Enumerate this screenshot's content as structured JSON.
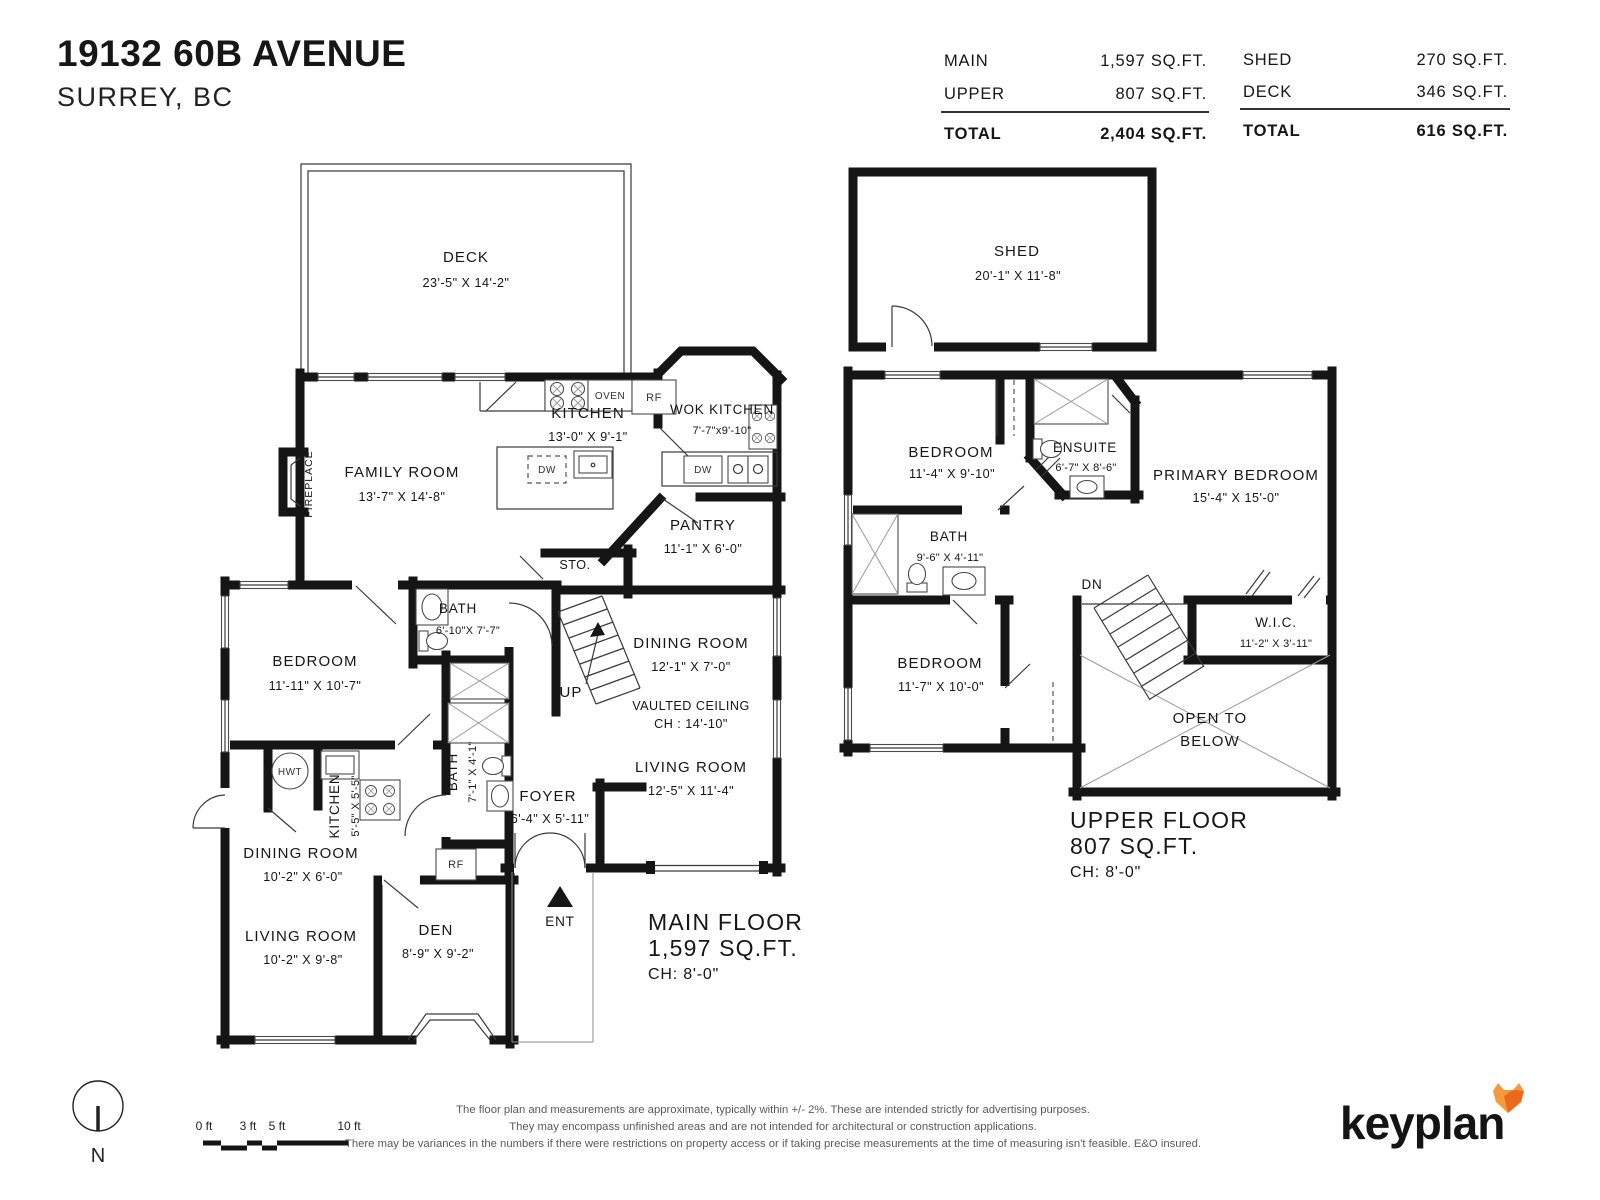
{
  "header": {
    "address_line1": "19132 60B AVENUE",
    "address_line2": "SURREY, BC",
    "table_left": {
      "rows": [
        {
          "label": "MAIN",
          "value": "1,597 SQ.FT."
        },
        {
          "label": "UPPER",
          "value": "807 SQ.FT."
        }
      ],
      "total_label": "TOTAL",
      "total_value": "2,404 SQ.FT."
    },
    "table_right": {
      "rows": [
        {
          "label": "SHED",
          "value": "270 SQ.FT."
        },
        {
          "label": "DECK",
          "value": "346 SQ.FT."
        }
      ],
      "total_label": "TOTAL",
      "total_value": "616 SQ.FT."
    }
  },
  "main_floor": {
    "deck": {
      "name": "DECK",
      "dims": "23'-5\" X 14'-2\""
    },
    "kitchen": {
      "name": "KITCHEN",
      "dims": "13'-0\" X 9'-1\""
    },
    "wok_kitchen": {
      "name": "WOK KITCHEN",
      "dims": "7'-7\"x9'-10\""
    },
    "family_room": {
      "name": "FAMILY ROOM",
      "dims": "13'-7\" X 14'-8\""
    },
    "pantry": {
      "name": "PANTRY",
      "dims": "11'-1\" X 6'-0\""
    },
    "storage": "STO.",
    "bath1": {
      "name": "BATH",
      "dims": "6'-10\"X 7'-7\""
    },
    "bedroom": {
      "name": "BEDROOM",
      "dims": "11'-11\" X 10'-7\""
    },
    "dining_room1": {
      "name": "DINING ROOM",
      "dims": "12'-1\" X 7'-0\""
    },
    "vaulted_ceiling": {
      "line1": "VAULTED CEILING",
      "line2": "CH : 14'-10\""
    },
    "living_room1": {
      "name": "LIVING ROOM",
      "dims": "12'-5\" X 11'-4\""
    },
    "bath2": {
      "name": "BATH",
      "dims": "7'-1\" X 4'-1\""
    },
    "kitchen2": {
      "name": "KITCHEN",
      "dims": "5'-5\" X 5'-5\""
    },
    "dining_room2": {
      "name": "DINING ROOM",
      "dims": "10'-2\" X 6'-0\""
    },
    "living_room2": {
      "name": "LIVING ROOM",
      "dims": "10'-2\" X 9'-8\""
    },
    "den": {
      "name": "DEN",
      "dims": "8'-9\" X 9'-2\""
    },
    "foyer": {
      "name": "FOYER",
      "dims": "6'-4\" X 5'-11\""
    },
    "up_label": "UP",
    "ent_label": "ENT",
    "fireplace_label": "FIREPLACE",
    "hwt_label": "HWT",
    "oven_label": "OVEN",
    "rf_label": "RF",
    "dw_label": "DW",
    "floor_title": "MAIN FLOOR",
    "floor_area": "1,597 SQ.FT.",
    "floor_ch": "CH: 8'-0\""
  },
  "upper_floor": {
    "shed": {
      "name": "SHED",
      "dims": "20'-1\" X 11'-8\""
    },
    "bedroom1": {
      "name": "BEDROOM",
      "dims": "11'-4\" X 9'-10\""
    },
    "ensuite": {
      "name": "ENSUITE",
      "dims": "6'-7\" X 8'-6\""
    },
    "primary_bedroom": {
      "name": "PRIMARY BEDROOM",
      "dims": "15'-4\" X 15'-0\""
    },
    "bath": {
      "name": "BATH",
      "dims": "9'-6\" X 4'-11\""
    },
    "bedroom2": {
      "name": "BEDROOM",
      "dims": "11'-7\" X 10'-0\""
    },
    "wic": {
      "name": "W.I.C.",
      "dims": "11'-2\" X 3'-11\""
    },
    "open_below_line1": "OPEN TO",
    "open_below_line2": "BELOW",
    "dn_label": "DN",
    "floor_title": "UPPER FLOOR",
    "floor_area": "807 SQ.FT.",
    "floor_ch": "CH: 8'-0\""
  },
  "footer": {
    "north_label": "N",
    "scale_labels": [
      "0 ft",
      "3 ft",
      "5 ft",
      "10 ft"
    ],
    "disclaimer_line1": "The floor plan and measurements are approximate, typically within +/- 2%. These are intended strictly for advertising purposes.",
    "disclaimer_line2": "They may encompass unfinished areas and are not intended for architectural or construction applications.",
    "disclaimer_line3": "There may be variances in the numbers if there were restrictions on property access or if taking precise measurements at the time of measuring isn't feasible. E&O insured.",
    "logo_text": "keyplan",
    "logo_color": "#141414",
    "fox_color_light": "#F49A3C",
    "fox_color_dark": "#E96A1E"
  }
}
